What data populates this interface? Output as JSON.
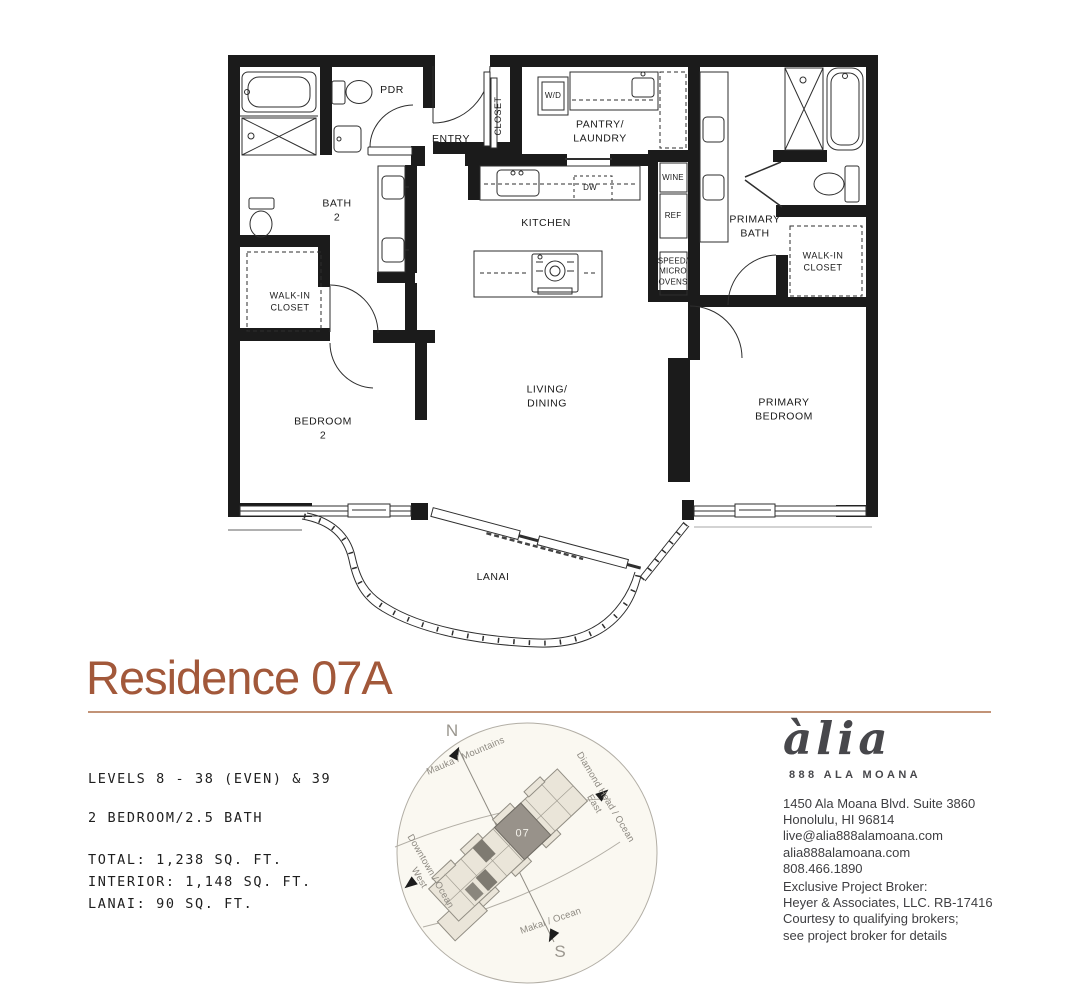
{
  "title": "Residence 07A",
  "plan": {
    "rooms": {
      "pdr": "PDR",
      "entry": "ENTRY",
      "closet": "CLOSET",
      "wd": "W/D",
      "pantry": "PANTRY/\nLAUNDRY",
      "dw": "DW",
      "kitchen": "KITCHEN",
      "wine": "WINE",
      "ref": "REF",
      "ovens": "SPEED/\nMICRO\nOVENS",
      "primary_bath": "PRIMARY\nBATH",
      "walkin_right": "WALK-IN\nCLOSET",
      "bath2": "BATH\n2",
      "walkin_left": "WALK-IN\nCLOSET",
      "bedroom2": "BEDROOM\n2",
      "living": "LIVING/\nDINING",
      "primary_bedroom": "PRIMARY\nBEDROOM",
      "lanai": "LANAI"
    }
  },
  "specs": {
    "levels": "LEVELS 8 - 38 (EVEN) & 39",
    "config": "2 BEDROOM/2.5 BATH",
    "areas": "TOTAL: 1,238 SQ. FT.\nINTERIOR: 1,148 SQ. FT.\nLANAI: 90 SQ. FT."
  },
  "compass": {
    "north": "N",
    "south": "S",
    "mauka": "Mauka / Mountains",
    "diamond_head": "Diamond Head / Ocean\nEast",
    "downtown": "Downtown / Ocean\nWest",
    "makai": "Makai / Ocean",
    "unit": "07"
  },
  "branding": {
    "logo": "àlia",
    "tagline": "888 ALA MOANA",
    "address": "1450 Ala Moana Blvd. Suite 3860\nHonolulu, HI 96814\nlive@alia888alamoana.com\nalia888alamoana.com\n808.466.1890",
    "broker": "Exclusive Project Broker:\nHeyer & Associates, LLC. RB-17416\nCourtesy to qualifying brokers;\nsee project broker for details"
  },
  "colors": {
    "accent": "#A2583A",
    "divider": "#C29377",
    "wall": "#1B1B1B",
    "building_highlight": "#98928A"
  }
}
